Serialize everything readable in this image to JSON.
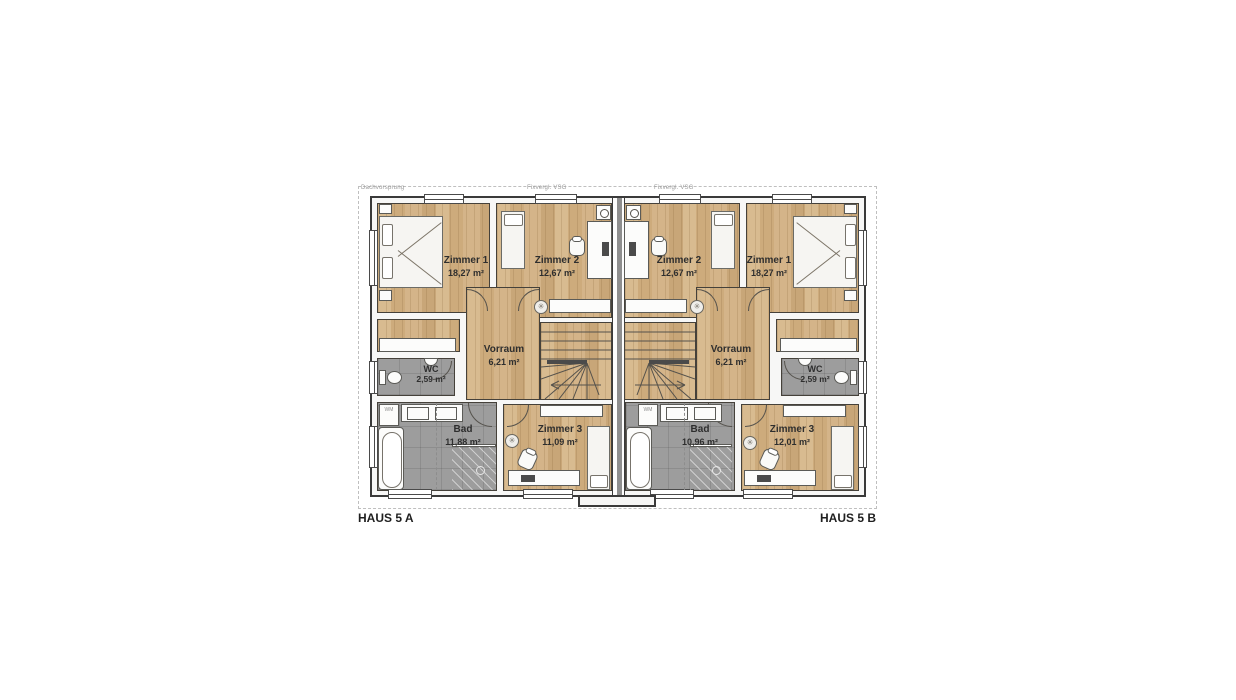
{
  "annotations": {
    "dachvorsprung": "Dachvorsprung",
    "fixverglazing": "Fixvergl. VSG"
  },
  "appliances": {
    "washing_machine": "WM"
  },
  "houses": {
    "a": {
      "label": "HAUS 5 A",
      "rooms": {
        "z1": {
          "name": "Zimmer 1",
          "area": "18,27 m²"
        },
        "z2": {
          "name": "Zimmer 2",
          "area": "12,67 m²"
        },
        "vorraum": {
          "name": "Vorraum",
          "area": "6,21 m²"
        },
        "wc": {
          "name": "WC",
          "area": "2,59 m²"
        },
        "bad": {
          "name": "Bad",
          "area": "11,88 m²"
        },
        "z3": {
          "name": "Zimmer 3",
          "area": "11,09 m²"
        }
      }
    },
    "b": {
      "label": "HAUS 5 B",
      "rooms": {
        "z2": {
          "name": "Zimmer 2",
          "area": "12,67 m²"
        },
        "z1": {
          "name": "Zimmer 1",
          "area": "18,27 m²"
        },
        "vorraum": {
          "name": "Vorraum",
          "area": "6,21 m²"
        },
        "wc": {
          "name": "WC",
          "area": "2,59 m²"
        },
        "bad": {
          "name": "Bad",
          "area": "10,96 m²"
        },
        "z3": {
          "name": "Zimmer 3",
          "area": "12,01 m²"
        }
      }
    }
  },
  "colors": {
    "wood_floor": "#d3b488",
    "tile_floor": "#9d9d9d",
    "wall_outline": "#3a3a3a",
    "roofline_dash": "#bfbfbf"
  }
}
